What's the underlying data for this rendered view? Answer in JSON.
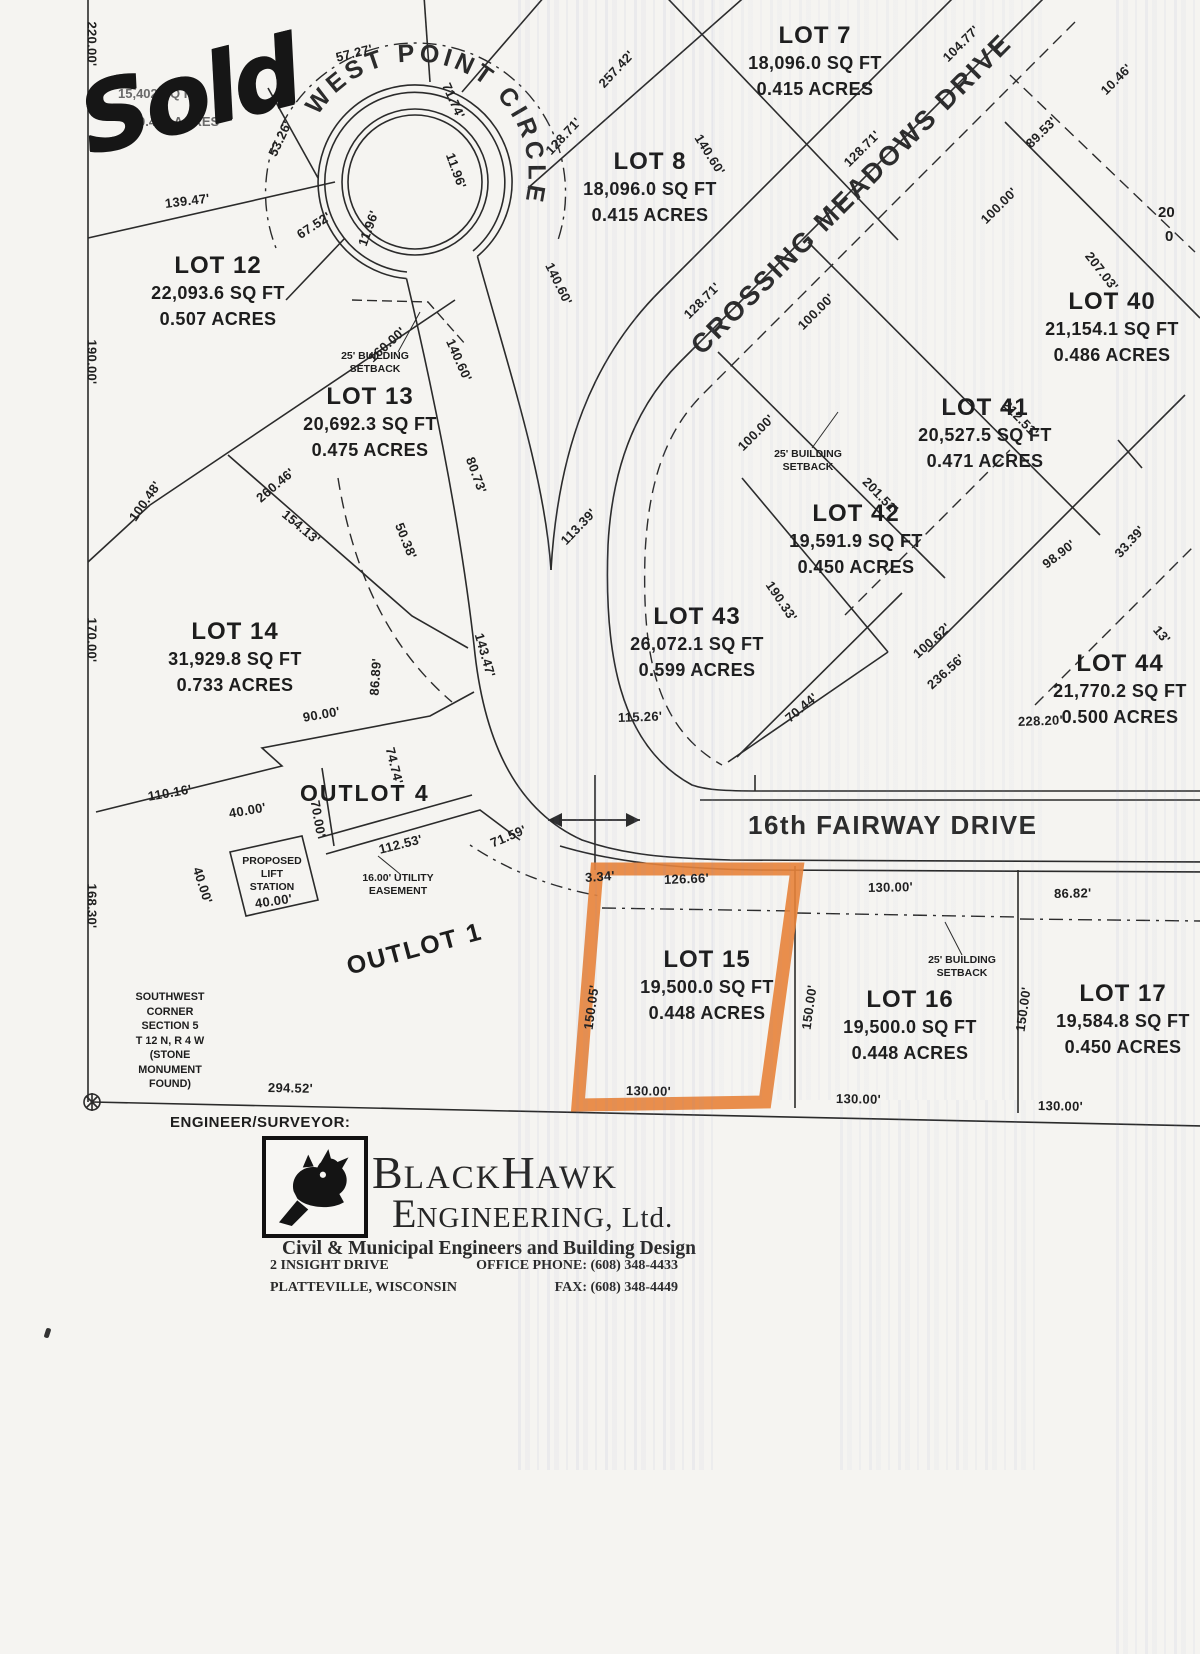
{
  "page": {
    "bg": "#f5f4f1",
    "ink": "#222222",
    "highlight_orange": "#e8833a",
    "streak_tint": "#7684bc"
  },
  "annotation": {
    "sold": "Sold",
    "obscured_sqft": "15,402 SQ FT",
    "obscured_acres": "0.445 ACRES"
  },
  "streets": {
    "west_point_circle": "WEST POINT CIRCLE",
    "crossing_meadows_drive": "CROSSING MEADOWS DRIVE",
    "fairway_drive": "16th FAIRWAY DRIVE"
  },
  "lots": [
    {
      "name": "LOT 7",
      "sqft": "18,096.0 SQ FT",
      "acres": "0.415 ACRES"
    },
    {
      "name": "LOT 8",
      "sqft": "18,096.0 SQ FT",
      "acres": "0.415 ACRES"
    },
    {
      "name": "LOT 12",
      "sqft": "22,093.6 SQ FT",
      "acres": "0.507 ACRES"
    },
    {
      "name": "LOT 13",
      "sqft": "20,692.3 SQ FT",
      "acres": "0.475 ACRES"
    },
    {
      "name": "LOT 14",
      "sqft": "31,929.8 SQ FT",
      "acres": "0.733 ACRES"
    },
    {
      "name": "LOT 40",
      "sqft": "21,154.1 SQ FT",
      "acres": "0.486 ACRES"
    },
    {
      "name": "LOT 41",
      "sqft": "20,527.5 SQ FT",
      "acres": "0.471 ACRES"
    },
    {
      "name": "LOT 42",
      "sqft": "19,591.9 SQ FT",
      "acres": "0.450 ACRES"
    },
    {
      "name": "LOT 43",
      "sqft": "26,072.1 SQ FT",
      "acres": "0.599 ACRES"
    },
    {
      "name": "LOT 44",
      "sqft": "21,770.2 SQ FT",
      "acres": "0.500 ACRES"
    },
    {
      "name": "LOT 15",
      "sqft": "19,500.0 SQ FT",
      "acres": "0.448 ACRES"
    },
    {
      "name": "LOT 16",
      "sqft": "19,500.0 SQ FT",
      "acres": "0.448 ACRES"
    },
    {
      "name": "LOT 17",
      "sqft": "19,584.8 SQ FT",
      "acres": "0.450 ACRES"
    }
  ],
  "outlots": {
    "outlot_4": "OUTLOT 4",
    "outlot_1": "OUTLOT 1"
  },
  "partial_lot_edge": {
    "line1": "20",
    "line2": "0"
  },
  "setback_note": {
    "line1": "25' BUILDING",
    "line2": "SETBACK"
  },
  "easement_note": {
    "line1": "16.00' UTILITY",
    "line2": "EASEMENT"
  },
  "lift_station_note": {
    "line1": "PROPOSED",
    "line2": "LIFT",
    "line3": "STATION"
  },
  "monument_note": [
    "SOUTHWEST",
    "CORNER",
    "SECTION 5",
    "T 12 N, R 4 W",
    "(STONE",
    "MONUMENT",
    "FOUND)"
  ],
  "dims": [
    "220.00'",
    "190.00'",
    "170.00'",
    "168.30'",
    "139.47'",
    "57.27'",
    "71.74'",
    "11.96'",
    "53.26'",
    "67.52'",
    "11.96'",
    "257.42'",
    "128.71'",
    "140.60'",
    "128.71'",
    "104.77'",
    "10.46'",
    "89.53'",
    "100.00'",
    "207.03'",
    "128.71'",
    "100.00'",
    "140.60'",
    "160.00'",
    "260.46'",
    "100.48'",
    "154.13'",
    "140.60'",
    "80.73'",
    "50.38'",
    "113.39'",
    "212.51'",
    "100.00'",
    "201.51'",
    "190.33'",
    "98.90'",
    "33.39'",
    "143.47'",
    "86.89'",
    "100.62'",
    "236.56'",
    "70.44'",
    "115.26'",
    "228.20'",
    "90.00'",
    "74.74'",
    "110.16'",
    "40.00'",
    "70.00'",
    "40.00'",
    "112.53'",
    "40.00'",
    "71.59'",
    "3.34'",
    "126.66'",
    "130.00'",
    "86.82'",
    "150.05'",
    "150.00'",
    "150.00'",
    "294.52'",
    "130.00'",
    "130.00'",
    "130.00'",
    "13'"
  ],
  "footer": {
    "surveyor_label": "ENGINEER/SURVEYOR:",
    "firm": {
      "p1": "B",
      "p2": "LACK",
      "p3": "H",
      "p4": "AWK",
      "l2p1": "E",
      "l2p2": "NGINEERING, Ltd."
    },
    "tagline": "Civil & Municipal Engineers and Building Design",
    "address_line1": "2 INSIGHT DRIVE",
    "address_line2": "PLATTEVILLE, WISCONSIN",
    "phone": "OFFICE PHONE: (608) 348-4433",
    "fax": "FAX: (608) 348-4449"
  }
}
